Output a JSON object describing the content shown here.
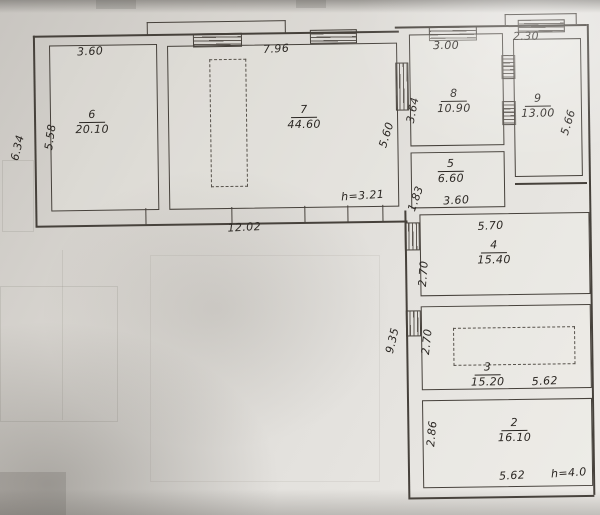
{
  "rooms": {
    "r6": {
      "number": "6",
      "area": "20.10",
      "width": "3.60",
      "depth": "5.58"
    },
    "r7": {
      "number": "7",
      "area": "44.60",
      "width": "7.96",
      "depth": "5.60"
    },
    "r8": {
      "number": "8",
      "area": "10.90",
      "width": "3.00",
      "depth": "3.64"
    },
    "r9": {
      "number": "9",
      "area": "13.00",
      "width": "2.30",
      "depth": "5.66"
    },
    "r5": {
      "number": "5",
      "area": "6.60",
      "width": "3.60",
      "depth": "1.83"
    },
    "r4": {
      "number": "4",
      "area": "15.40",
      "width": "5.70",
      "depth": "2.70"
    },
    "r3": {
      "number": "3",
      "area": "15.20",
      "width": "5.62",
      "depth": "2.70"
    },
    "r2": {
      "number": "2",
      "area": "16.10",
      "width": "5.62",
      "depth": "2.86"
    }
  },
  "dimensions": {
    "exterior_height_left": "6.34",
    "left_wing_width": "12.02",
    "ceiling_height_left": "h=3.21",
    "right_wing_height": "9.35",
    "ceiling_height_right": "h=4.0"
  },
  "colors": {
    "ink": "#46413b",
    "paper": "#e0ddd8"
  }
}
